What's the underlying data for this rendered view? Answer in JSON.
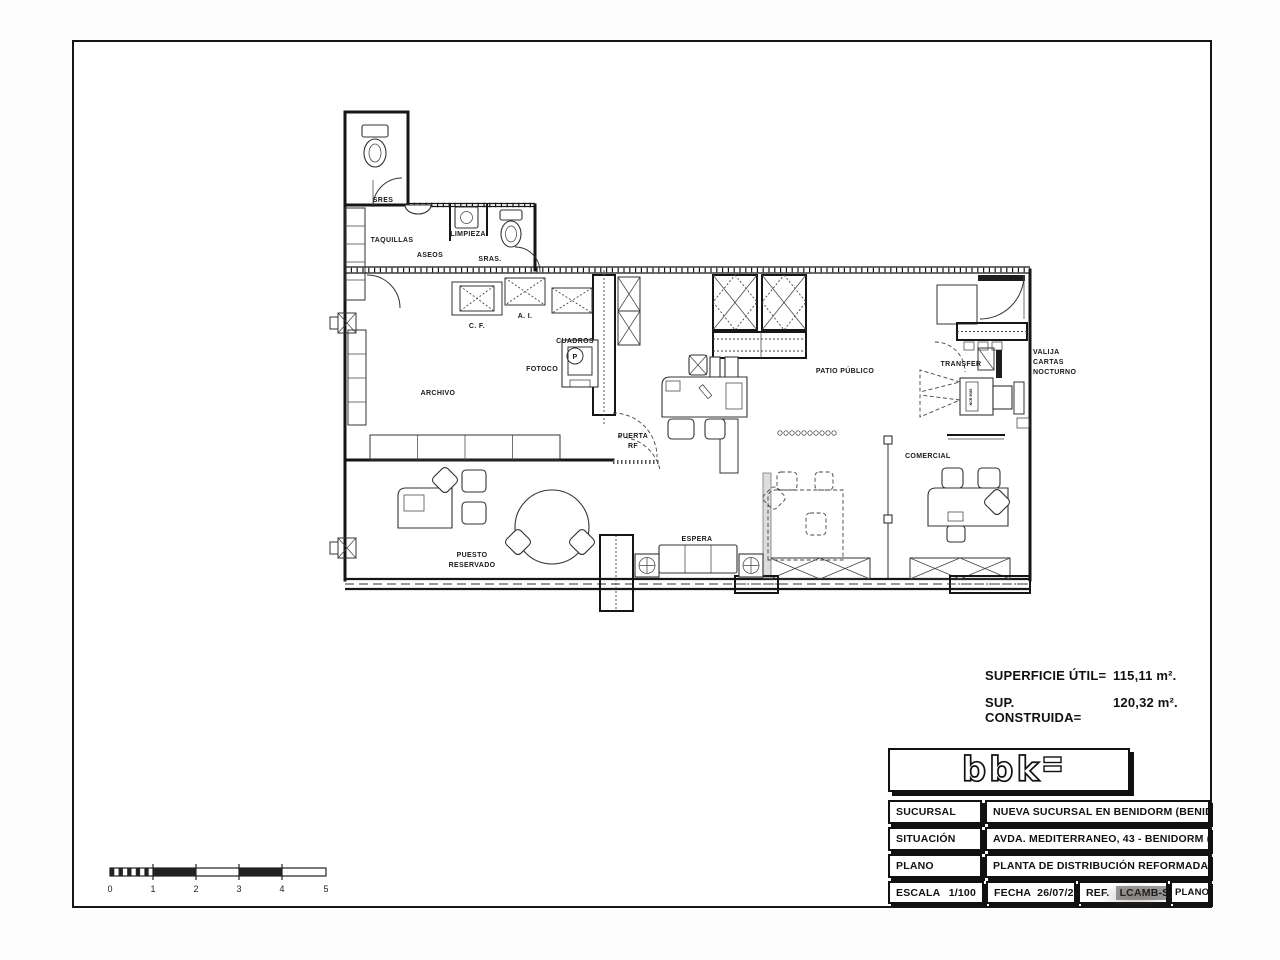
{
  "plan_labels": {
    "sres": "SRES",
    "taquillas": "TAQUILLAS",
    "aseos": "ASEOS",
    "limpieza": "LIMPIEZA",
    "sras": "SRAS.",
    "cf": "C. F.",
    "ai": "A. I.",
    "cuadros": "CUADROS",
    "p": "P",
    "fotoco": "FOTOCO",
    "archivo": "ARCHIVO",
    "puerta_1": "PUERTA",
    "puerta_2": "RF",
    "patio": "PATIO PÚBLICO",
    "transfer": "TRANSFER",
    "valija_1": "VALIJA",
    "valija_2": "CARTAS",
    "valija_3": "NOCTURNO",
    "atm": "NCR 5085",
    "comercial": "COMERCIAL",
    "puesto_1": "PUESTO",
    "puesto_2": "RESERVADO",
    "espera": "ESPERA"
  },
  "areas": {
    "util_label": "SUPERFICIE ÚTIL=",
    "util_value": "115,11 m².",
    "constr_label": "SUP. CONSTRUIDA=",
    "constr_value": "120,32 m²."
  },
  "title_block": {
    "logo_text": "bbk",
    "rows": [
      {
        "label": "SUCURSAL",
        "value": "NUEVA SUCURSAL EN BENIDORM (BENIDORM II)"
      },
      {
        "label": "SITUACIÓN",
        "value": "AVDA. MEDITERRANEO, 43 - BENIDORM (ALICANTE)"
      },
      {
        "label": "PLANO",
        "value": "PLANTA DE DISTRIBUCIÓN REFORMADA - SOLUCIÓN 2"
      }
    ],
    "escala_label": "ESCALA",
    "escala_value": "1/100",
    "fecha_label": "FECHA",
    "fecha_value": "26/07/2006",
    "ref_label": "REF.",
    "ref_value": "LCAMB-S2",
    "plano_num_label": "PLANO Nº"
  },
  "scale_bar": {
    "ticks": [
      "0",
      "1",
      "2",
      "3",
      "4",
      "5"
    ]
  }
}
